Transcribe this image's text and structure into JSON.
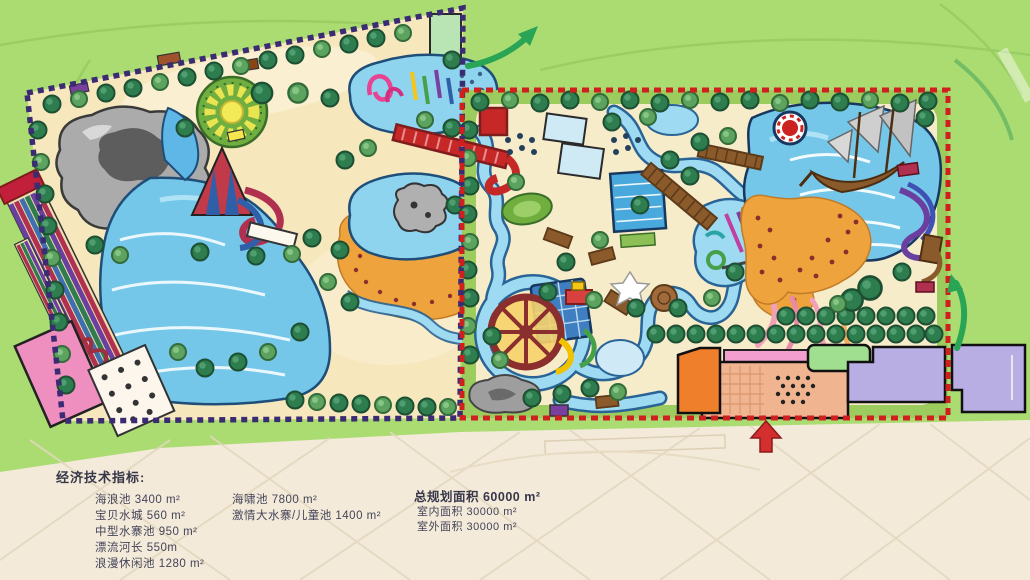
{
  "page": {
    "kind": "water-park-master-plan-rendering",
    "language": "zh-CN"
  },
  "legend": {
    "heading": "经济技术指标:",
    "col1": [
      "海浪池 3400 m²",
      "宝贝水城 560 m²",
      "中型水寨池 950 m²",
      "漂流河长 550m",
      "浪漫休闲池 1280 m²"
    ],
    "col2": [
      "海啸池 7800 m²",
      "激情大水寨/儿童池 1400 m²"
    ],
    "total_heading": "总规划面积 60000 m²",
    "col3": [
      "室内面积 30000 m²",
      "室外面积 30000 m²"
    ]
  },
  "palette": {
    "field_green": "#abdc72",
    "paper_beige": "#f3ead9",
    "ground_tan": "#f6e7bd",
    "water_blue": "#74c7e8",
    "beach_orange": "#efa33c",
    "tree_green": "#2e7d4f",
    "west_boundary_purple": "#3b2b73",
    "east_boundary_red": "#cf1f1f"
  },
  "map_features": [
    "rock-mountain",
    "wave-pool",
    "racing-slides",
    "sun-plaza",
    "cone-slide-tower",
    "kids-pool",
    "rock-island-pond",
    "pink-building",
    "terrace",
    "green-lot",
    "red-bridge",
    "pale-pools",
    "swimming-pool",
    "golf-green",
    "lazy-river",
    "water-castle-wheel",
    "wooden-boardwalk",
    "play-pond",
    "tsunami-pool",
    "pirate-ship",
    "sand-beach",
    "slide-complex",
    "tree-grid",
    "entry-plaza",
    "orange-building",
    "green-building",
    "lavender-buildings",
    "gray-rock",
    "north-exit-arrow",
    "east-exit-arrow",
    "entrance-arrow"
  ]
}
